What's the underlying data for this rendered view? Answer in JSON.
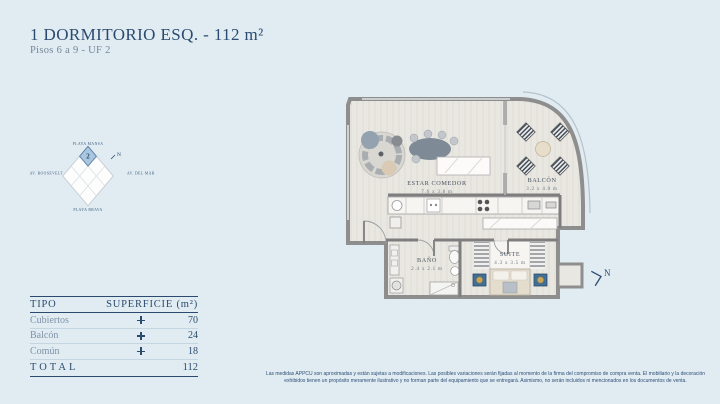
{
  "page": {
    "background": "#e1ecf2",
    "accent": "#2b4a6f"
  },
  "header": {
    "title": "1 DORMITORIO ESQ. - 112 m²",
    "subtitle": "Pisos 6 a 9 - UF 2"
  },
  "locator": {
    "unit_number": "2",
    "north_label": "N",
    "labels": {
      "top": "PLAYA MANSA",
      "left": "AV. ROOSEVELT",
      "right": "AV. DEL MAR",
      "bottom": "PLAYA BRAVA"
    }
  },
  "floorplan": {
    "north_label": "N",
    "rooms": [
      {
        "name": "ESTAR COMEDOR",
        "dims": "7.6 x 3.8 m"
      },
      {
        "name": "BALCÓN",
        "dims": "3.2 x 4.0 m"
      },
      {
        "name": "BAÑO",
        "dims": "2.4 x 2.1 m"
      },
      {
        "name": "SUITE",
        "dims": "4.3 x 3.5 m"
      }
    ]
  },
  "table": {
    "col_tipo": "TIPO",
    "col_superficie": "SUPERFICIE (m²)",
    "rows": [
      {
        "tipo": "Cubiertos",
        "value": "70"
      },
      {
        "tipo": "Balcón",
        "value": "24"
      },
      {
        "tipo": "Común",
        "value": "18"
      }
    ],
    "total_label": "TOTAL",
    "total_value": "112"
  },
  "disclaimer": "Las medidas APPCU son aproximadas y están sujetas a modificaciones. Las posibles variaciones serán fijadas al momento de la firma del compromiso de compra venta. El mobiliario y la decoración exhibidos tienen un propósito meramente ilustrativo y no forman parte del equipamiento que se entregará. Asimismo, no serán incluidos ni mencionados en los documentos de venta."
}
